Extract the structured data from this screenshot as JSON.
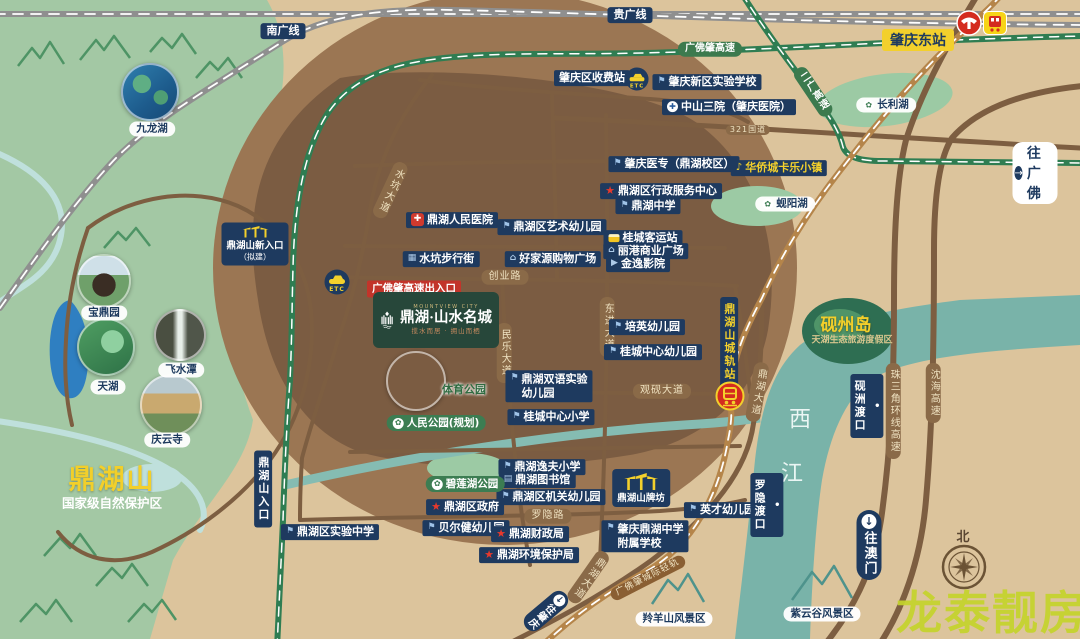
{
  "logo": {
    "en": "MOUNTVIEW CITY",
    "name": "鼎湖·山水名城",
    "slogan": "揽水而居 · 拥山而栖"
  },
  "watermark": "龙泰靓房",
  "compass": {
    "north": "北"
  },
  "special": {
    "east_station": "肇庆东站",
    "to_guangfo": "往广佛",
    "to_macau": "往澳门",
    "to_zhaoqing": "往肇庆",
    "new_entrance_line1": "鼎湖山新入口",
    "new_entrance_line2": "（拟建）",
    "paifang_label": "鼎湖山牌坊",
    "mountain_title": "鼎湖山",
    "mountain_sub": "国家级自然保护区",
    "etc_text": "ETC",
    "arrow_right": "→",
    "arrow_down": "↓"
  },
  "icons": {
    "school": "⚑",
    "hospital": "✚",
    "redcross": "✚",
    "star": "★",
    "music": "♪",
    "leaf": "✿",
    "shop": "⌂",
    "film": "▶",
    "book": "▤",
    "walk": "▦",
    "dot": "•",
    "bus": ""
  },
  "photos": [
    {
      "id": "jiulonghu",
      "label": "九龙湖",
      "x": 150,
      "y": 92,
      "r": 27,
      "lx": 152,
      "ly": 129,
      "ls": "white"
    },
    {
      "id": "baodingyuan",
      "label": "宝鼎园",
      "x": 104,
      "y": 281,
      "r": 25,
      "lx": 104,
      "ly": 313,
      "ls": "white"
    },
    {
      "id": "tianhu",
      "label": "天湖",
      "x": 106,
      "y": 347,
      "r": 27,
      "lx": 108,
      "ly": 387,
      "ls": "white"
    },
    {
      "id": "feishuitan",
      "label": "飞水潭",
      "x": 180,
      "y": 335,
      "r": 24,
      "lx": 181,
      "ly": 370,
      "ls": "white"
    },
    {
      "id": "qingyunsi",
      "label": "庆云寺",
      "x": 171,
      "y": 405,
      "r": 29,
      "lx": 167,
      "ly": 440,
      "ls": "white"
    },
    {
      "id": "sports-park",
      "label": "体育公园",
      "x": 416,
      "y": 381,
      "r": 28,
      "lx": 464,
      "ly": 390,
      "ls": "tgreen"
    }
  ],
  "map_labels": [
    {
      "id": "rail-guiguang",
      "t": "贵广线",
      "s": "rail",
      "x": 630,
      "y": 15
    },
    {
      "id": "rail-nanguang",
      "t": "南广线",
      "s": "rail",
      "x": 283,
      "y": 31
    },
    {
      "id": "hwy-gfz",
      "t": "广佛肇高速",
      "s": "groad",
      "x": 710,
      "y": 49
    },
    {
      "id": "hwy-erguang",
      "t": "二广高速",
      "s": "groadv",
      "x": 813,
      "y": 92,
      "r": -34
    },
    {
      "id": "road-g321",
      "t": "321国道",
      "s": "road roadt",
      "x": 748,
      "y": 130
    },
    {
      "id": "toll-station",
      "t": "肇庆区收费站",
      "s": "navy",
      "x": 592,
      "y": 78
    },
    {
      "id": "xinqu-school",
      "t": "肇庆新区实验学校",
      "s": "navy",
      "i": "school",
      "x": 707,
      "y": 82
    },
    {
      "id": "zhongshan-hospital",
      "t": "中山三院（肇庆医院）",
      "s": "navy",
      "i": "hospital",
      "x": 729,
      "y": 107
    },
    {
      "id": "yizhuan",
      "t": "肇庆医专（鼎湖校区）",
      "s": "navy",
      "i": "school",
      "x": 674,
      "y": 164
    },
    {
      "id": "admin-center",
      "t": "鼎湖区行政服务中心",
      "s": "navy",
      "i": "star",
      "x": 661,
      "y": 191
    },
    {
      "id": "dinghu-middle",
      "t": "鼎湖中学",
      "s": "navy",
      "i": "school",
      "x": 648,
      "y": 206
    },
    {
      "id": "renmin-hospital",
      "t": "鼎湖人民医院",
      "s": "navy",
      "i": "redcross",
      "x": 452,
      "y": 220
    },
    {
      "id": "art-kindergarten",
      "t": "鼎湖区艺术幼儿园",
      "s": "navy",
      "i": "school",
      "x": 552,
      "y": 227
    },
    {
      "id": "bus-terminal",
      "t": "桂城客运站",
      "s": "navy",
      "i": "bus",
      "x": 643,
      "y": 238
    },
    {
      "id": "ligang-plaza",
      "t": "丽港商业广场",
      "s": "navy",
      "i": "shop",
      "x": 646,
      "y": 251
    },
    {
      "id": "jinyi-cinema",
      "t": "金逸影院",
      "s": "navy",
      "i": "film",
      "x": 638,
      "y": 264
    },
    {
      "id": "shuikeng-street",
      "t": "水坑步行街",
      "s": "navy",
      "i": "walk",
      "x": 441,
      "y": 259
    },
    {
      "id": "haojiayuan",
      "t": "好家源购物广场",
      "s": "navy",
      "i": "shop",
      "x": 553,
      "y": 259
    },
    {
      "id": "chuangye-road",
      "t": "创业路",
      "s": "road",
      "x": 505,
      "y": 277
    },
    {
      "id": "gfz-exit",
      "t": "广佛肇高速出入口",
      "s": "red",
      "x": 414,
      "y": 289
    },
    {
      "id": "shuikeng-ave",
      "t": "水坑大道",
      "s": "roadv",
      "x": 390,
      "y": 190,
      "r": 25
    },
    {
      "id": "minle-ave",
      "t": "民乐大道",
      "s": "roadv",
      "x": 504,
      "y": 353
    },
    {
      "id": "dongjin-ave",
      "t": "东进大道",
      "s": "roadv",
      "x": 607,
      "y": 327
    },
    {
      "id": "peiying-kg",
      "t": "培英幼儿园",
      "s": "navy",
      "i": "school",
      "x": 647,
      "y": 327
    },
    {
      "id": "guicheng-kg",
      "t": "桂城中心幼儿园",
      "s": "navy",
      "i": "school",
      "x": 653,
      "y": 352
    },
    {
      "id": "rail-station-label",
      "t": "鼎湖山城轨站",
      "s": "navyv navyvy",
      "x": 729,
      "y": 342
    },
    {
      "id": "dinghu-ave",
      "t": "鼎湖大道",
      "s": "roadv",
      "x": 757,
      "y": 392,
      "r": 10
    },
    {
      "id": "guanyan-ave",
      "t": "观砚大道",
      "s": "road",
      "x": 662,
      "y": 391
    },
    {
      "id": "yanzhou-island",
      "t": "砚州岛",
      "s": "tybig",
      "x": 846,
      "y": 326
    },
    {
      "id": "tianhu-resort",
      "t": "天湖生态旅游度假区",
      "s": "tgold",
      "x": 852,
      "y": 341
    },
    {
      "id": "river-xi",
      "t": "西",
      "s": "triver",
      "x": 800,
      "y": 419
    },
    {
      "id": "river-jiang",
      "t": "江",
      "s": "triver",
      "x": 792,
      "y": 473
    },
    {
      "id": "yanzhou-ferry",
      "t": "砚洲渡口",
      "s": "navyv",
      "i": "dot",
      "x": 867,
      "y": 406
    },
    {
      "id": "zsj-hwy",
      "t": "珠三角环线高速",
      "s": "roadv",
      "x": 893,
      "y": 411
    },
    {
      "id": "shenhai-hwy",
      "t": "沈海高速",
      "s": "roadv",
      "x": 933,
      "y": 393
    },
    {
      "id": "shuangyu-kg",
      "t": "鼎湖双语实验\n幼儿园",
      "s": "navy2",
      "i": "school",
      "x": 549,
      "y": 386
    },
    {
      "id": "gc-primary",
      "t": "桂城中心小学",
      "s": "navy",
      "i": "school",
      "x": 551,
      "y": 417
    },
    {
      "id": "renmin-park",
      "t": "人民公园(规划)",
      "s": "green",
      "i": "leaf",
      "x": 436,
      "y": 423
    },
    {
      "id": "yifu-primary",
      "t": "鼎湖逸夫小学",
      "s": "navy",
      "i": "school",
      "x": 542,
      "y": 467
    },
    {
      "id": "library",
      "t": "鼎湖图书馆",
      "s": "navy",
      "i": "book",
      "x": 537,
      "y": 480
    },
    {
      "id": "jiguan-kg",
      "t": "鼎湖区机关幼儿园",
      "s": "navy",
      "i": "school",
      "x": 551,
      "y": 497
    },
    {
      "id": "bilianhu-park",
      "t": "碧莲湖公园",
      "s": "green",
      "i": "leaf",
      "x": 465,
      "y": 484
    },
    {
      "id": "district-gov",
      "t": "鼎湖区政府",
      "s": "navy",
      "i": "star",
      "x": 465,
      "y": 507
    },
    {
      "id": "beierjian-kg",
      "t": "贝尔健幼儿园",
      "s": "navy",
      "i": "school",
      "x": 466,
      "y": 528
    },
    {
      "id": "finance-bureau",
      "t": "鼎湖财政局",
      "s": "navy",
      "i": "star",
      "x": 530,
      "y": 534
    },
    {
      "id": "env-bureau",
      "t": "鼎湖环境保护局",
      "s": "navy",
      "i": "star",
      "x": 529,
      "y": 555
    },
    {
      "id": "luoyin-road",
      "t": "罗隐路",
      "s": "road",
      "x": 548,
      "y": 516
    },
    {
      "id": "fushu-school",
      "t": "肇庆鼎湖中学\n附属学校",
      "s": "navy2",
      "i": "school",
      "x": 645,
      "y": 536
    },
    {
      "id": "yingcai-kg",
      "t": "英才幼儿园",
      "s": "navy",
      "i": "school",
      "x": 722,
      "y": 510
    },
    {
      "id": "luoyin-ferry",
      "t": "罗隐渡口",
      "s": "navyv",
      "i": "dot",
      "x": 767,
      "y": 505
    },
    {
      "id": "changlihu",
      "t": "长利湖",
      "s": "white",
      "i": "leaf",
      "x": 886,
      "y": 105
    },
    {
      "id": "xianyanghu",
      "t": "蚬阳湖",
      "s": "white",
      "i": "leaf",
      "x": 785,
      "y": 204
    },
    {
      "id": "oct-town",
      "t": "华侨城卡乐小镇",
      "s": "navy navyy",
      "i": "music",
      "x": 779,
      "y": 168
    },
    {
      "id": "ziyungu",
      "t": "紫云谷风景区",
      "s": "white",
      "x": 822,
      "y": 614
    },
    {
      "id": "lingyangshan",
      "t": "羚羊山风景区",
      "s": "white",
      "x": 674,
      "y": 619
    },
    {
      "id": "qgfz-lightrail",
      "t": "广佛肇城际轻轨",
      "s": "railbrown",
      "x": 648,
      "y": 578,
      "r": -27
    },
    {
      "id": "dinghu-ave-2",
      "t": "鼎湖大道",
      "s": "roadv",
      "x": 588,
      "y": 577,
      "r": 35
    },
    {
      "id": "shiyan-middle",
      "t": "鼎湖区实验中学",
      "s": "navy",
      "i": "school",
      "x": 330,
      "y": 532
    },
    {
      "id": "dhs-entrance",
      "t": "鼎湖山入口",
      "s": "navyv",
      "x": 263,
      "y": 489
    },
    {
      "id": "compass-north",
      "t": "北",
      "s": "tnorth",
      "x": 963,
      "y": 538
    }
  ]
}
